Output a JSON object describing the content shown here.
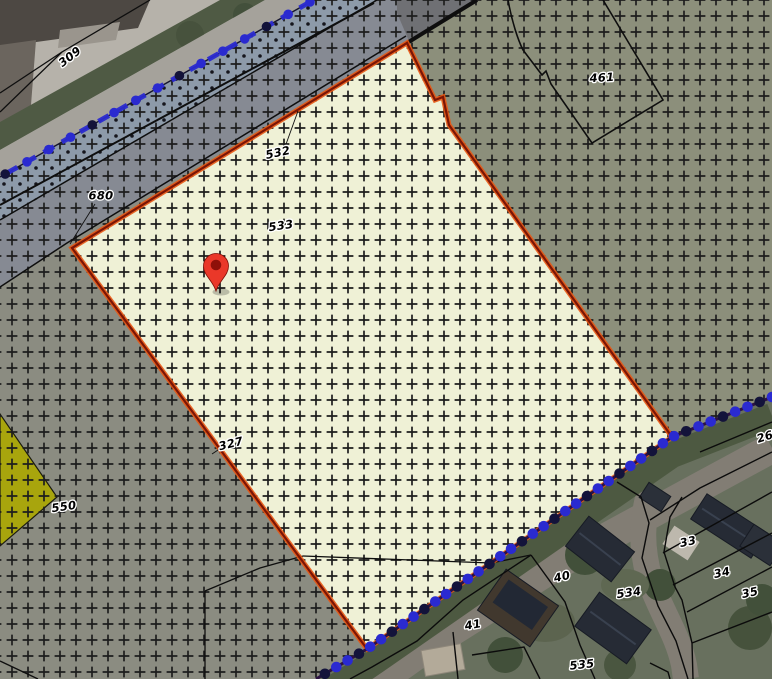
{
  "colors": {
    "selected_parcel_fill": "#eff1d6",
    "selected_parcel_border_outer": "#e85612",
    "selected_parcel_border_inner": "#7c1505",
    "zone_gray": "#8b8c81",
    "zone_gray_cool": "#868a93",
    "zone_green_gray": "#8c8f7b",
    "survey_band_blue": "#8d9aa9",
    "parcel_yellow": "#a8a50d",
    "hatch_cross": "#1d1d1d",
    "boundary_line": "#0e0e0e",
    "chain_marker_blue": "#2a2ad0",
    "chain_marker_dark": "#13133a",
    "pin_red": "#ea3829",
    "pin_core": "#8e1009"
  },
  "parcel_labels": [
    {
      "id": "309",
      "text": "309"
    },
    {
      "id": "680",
      "text": "680"
    },
    {
      "id": "532",
      "text": "532"
    },
    {
      "id": "533",
      "text": "533"
    },
    {
      "id": "461",
      "text": "461"
    },
    {
      "id": "327",
      "text": "327"
    },
    {
      "id": "550",
      "text": "550"
    },
    {
      "id": "26",
      "text": "26"
    },
    {
      "id": "33",
      "text": "33"
    },
    {
      "id": "34",
      "text": "34"
    },
    {
      "id": "35",
      "text": "35"
    },
    {
      "id": "40",
      "text": "40"
    },
    {
      "id": "41",
      "text": "41"
    },
    {
      "id": "534",
      "text": "534"
    },
    {
      "id": "535",
      "text": "535"
    }
  ]
}
